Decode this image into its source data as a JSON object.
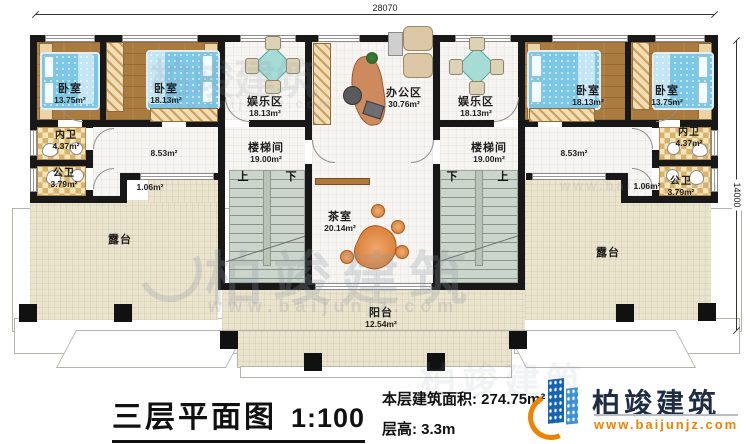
{
  "title_block": {
    "plan_title": "三层平面图",
    "plan_scale": "1:100",
    "area_label": "本层建筑面积:",
    "area_value": "274.75m²",
    "height_label": "层高:",
    "height_value": "3.3m"
  },
  "brand": {
    "name": "柏竣建筑",
    "website": "www.baijunjz.com",
    "colors": {
      "tower_blue": "#1664ae",
      "tower_light_blue": "#3f92d2",
      "swoosh_orange": "#ef8200",
      "name_dark": "#1f2d44"
    }
  },
  "dimensions": {
    "top_width": "28070",
    "right_height": "14000"
  },
  "watermark": {
    "text": "柏竣建筑",
    "url": "www.baijunjz.com"
  },
  "stairs": {
    "up": "上",
    "down": "下"
  },
  "rooms": {
    "bedroom_l1": {
      "name": "卧室",
      "area": "13.75m²"
    },
    "bedroom_l2": {
      "name": "卧室",
      "area": "18.13m²"
    },
    "entertainment_l": {
      "name": "娱乐区",
      "area": "18.13m²"
    },
    "office": {
      "name": "办公区",
      "area": "30.76m²"
    },
    "entertainment_r": {
      "name": "娱乐区",
      "area": "18.13m²"
    },
    "bedroom_r1": {
      "name": "卧室",
      "area": "18.13m²"
    },
    "bedroom_r2": {
      "name": "卧室",
      "area": "13.75m²"
    },
    "bath_ensuite_l": {
      "name": "内卫",
      "area": "4.37m²"
    },
    "bath_guest_l": {
      "name": "公卫",
      "area": "3.79m²"
    },
    "bath_ensuite_r": {
      "name": "内卫",
      "area": "4.37m²"
    },
    "bath_guest_r": {
      "name": "公卫",
      "area": "3.79m²"
    },
    "hall_l": {
      "area": "8.53m²"
    },
    "hall_r": {
      "area": "8.53m²"
    },
    "landing_l": {
      "area": "1.06m²"
    },
    "landing_r": {
      "area": "1.06m²"
    },
    "stairwell_l": {
      "name": "楼梯间",
      "area": "19.00m²"
    },
    "stairwell_r": {
      "name": "楼梯间",
      "area": "19.00m²"
    },
    "tearoom": {
      "name": "茶室",
      "area": "20.14m²"
    },
    "balcony": {
      "name": "阳台",
      "area": "12.54m²"
    },
    "terrace_l": {
      "name": "露台"
    },
    "terrace_r": {
      "name": "露台"
    }
  }
}
